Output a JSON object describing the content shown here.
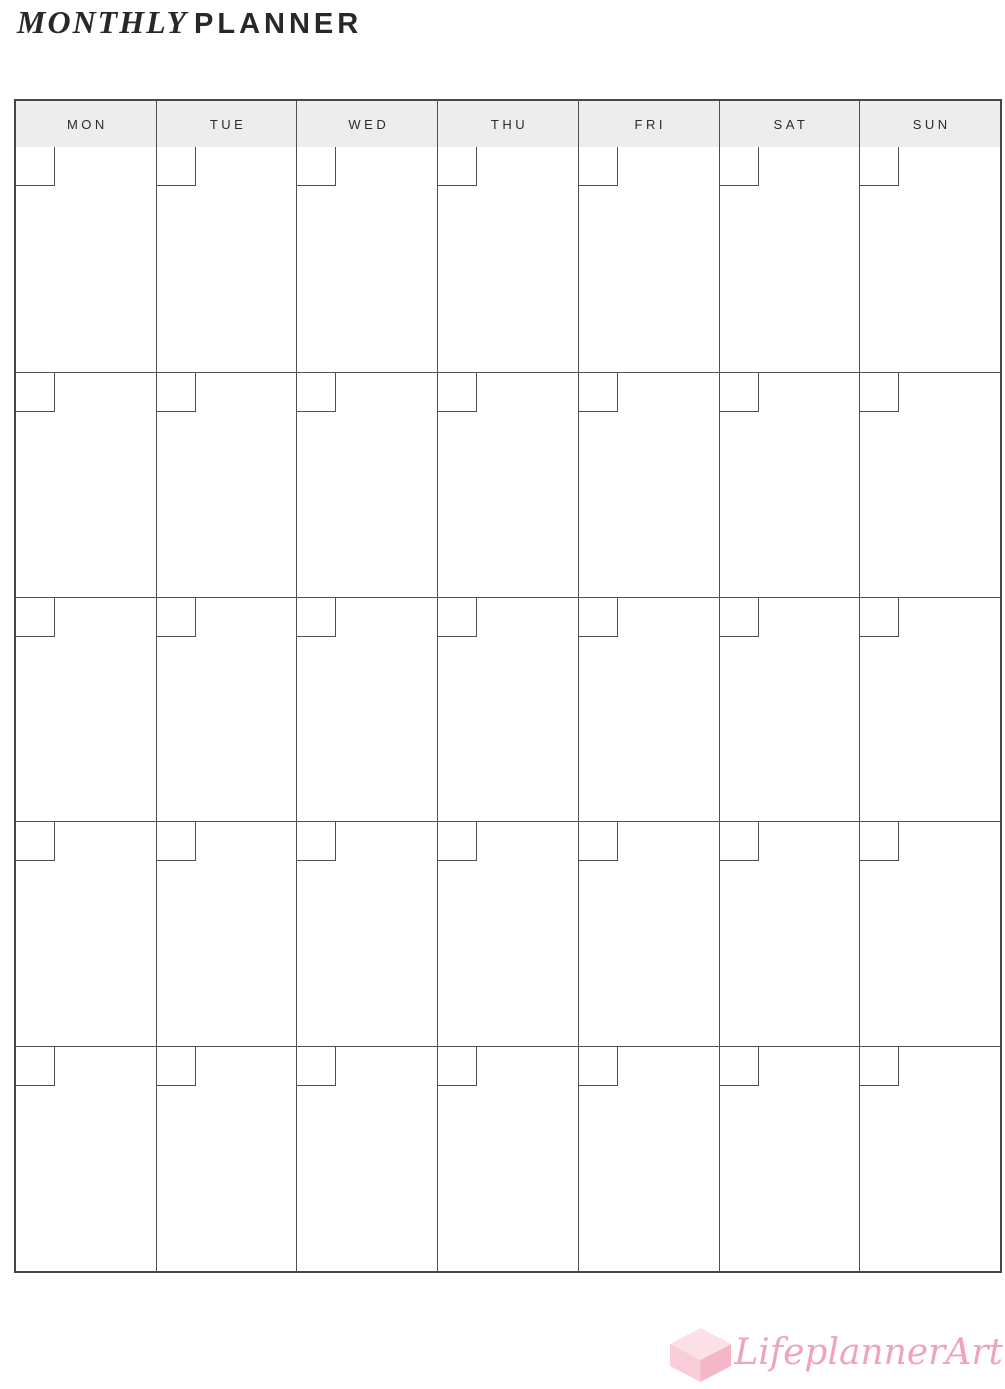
{
  "page": {
    "title_italic": "MONTHLY",
    "title_bold": "PLANNER"
  },
  "calendar": {
    "day_headers": [
      "MON",
      "TUE",
      "WED",
      "THU",
      "FRI",
      "SAT",
      "SUN"
    ],
    "week_count": 5,
    "days_per_week": 7,
    "header_bg": "#ededed",
    "line_color": "#4f4f51",
    "header_text_color": "#2b2b2d"
  },
  "branding": {
    "logo_text": "LifeplannerArt",
    "logo_text_color": "#f0a3bd",
    "cube_top_color": "#fce0e8",
    "cube_left_color": "#f9cdd9",
    "cube_right_color": "#f5b7c8"
  }
}
